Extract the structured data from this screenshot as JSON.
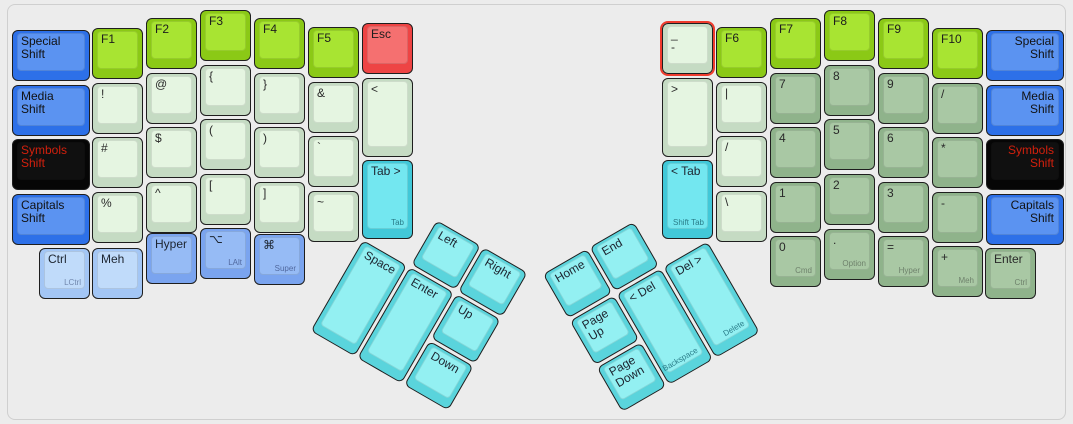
{
  "canvas": {
    "width": 1073,
    "height": 424,
    "background": "#ececec",
    "frame_border": "#cfcfcf",
    "selection_color": "#ef3b2d"
  },
  "palette": {
    "blue": {
      "base": "#2d70e8",
      "top": "#5b93f1",
      "text": "#111111",
      "sub": "#1f3a6e"
    },
    "black": {
      "base": "#060606",
      "top": "#101010",
      "text": "#d2200d",
      "sub": "#888888"
    },
    "green": {
      "base": "#8bc916",
      "top": "#a8e432",
      "text": "#1d1d1d",
      "sub": "#5d7d12"
    },
    "red": {
      "base": "#ee4444",
      "top": "#f57070",
      "text": "#1d1d1d",
      "sub": "#8a2525"
    },
    "mint": {
      "base": "#c5dbc3",
      "top": "#e5f5e1",
      "text": "#2a2a2a",
      "sub": "#7f917e"
    },
    "sage": {
      "base": "#8fb38b",
      "top": "#a9c8a4",
      "text": "#2a2a2a",
      "sub": "#6f826c"
    },
    "cyan": {
      "base": "#41c8d8",
      "top": "#73e7f0",
      "text": "#1d2530",
      "sub": "#2a7d89"
    },
    "cyanlight": {
      "base": "#5ad4dc",
      "top": "#93f0f2",
      "text": "#1d2530",
      "sub": "#2a7d89"
    },
    "bluelight": {
      "base": "#a3c6f5",
      "top": "#c0dbfa",
      "text": "#1d2530",
      "sub": "#7187ad"
    },
    "bluemed": {
      "base": "#7aa4ef",
      "top": "#96bbf5",
      "text": "#1d2530",
      "sub": "#51699f"
    }
  },
  "groups": {
    "left_thumb": {
      "x": 363,
      "y": 239.5,
      "rotation": 30
    },
    "right_thumb": {
      "x": 710,
      "y": 239.5,
      "rotation": -30
    }
  },
  "keys": [
    {
      "id": "special-shift-left",
      "label": "Special\nShift",
      "color": "blue",
      "x": 12,
      "y": 30,
      "w": 78
    },
    {
      "id": "media-shift-left",
      "label": "Media\nShift",
      "color": "blue",
      "x": 12,
      "y": 84.5,
      "w": 78
    },
    {
      "id": "symbols-shift-left",
      "label": "Symbols\nShift",
      "color": "black",
      "x": 12,
      "y": 139,
      "w": 78
    },
    {
      "id": "capitals-shift-left",
      "label": "Capitals\nShift",
      "color": "blue",
      "x": 12,
      "y": 193.5,
      "w": 78
    },
    {
      "id": "f1",
      "label": "F1",
      "color": "green",
      "x": 92,
      "y": 28
    },
    {
      "id": "exclamation",
      "label": "!",
      "color": "mint",
      "x": 92,
      "y": 82.5
    },
    {
      "id": "hash",
      "label": "#",
      "color": "mint",
      "x": 92,
      "y": 137
    },
    {
      "id": "percent",
      "label": "%",
      "color": "mint",
      "x": 92,
      "y": 191.5
    },
    {
      "id": "f2",
      "label": "F2",
      "color": "green",
      "x": 146,
      "y": 18
    },
    {
      "id": "at",
      "label": "@",
      "color": "mint",
      "x": 146,
      "y": 72.5
    },
    {
      "id": "dollar",
      "label": "$",
      "color": "mint",
      "x": 146,
      "y": 127
    },
    {
      "id": "caret",
      "label": "^",
      "color": "mint",
      "x": 146,
      "y": 181.5
    },
    {
      "id": "f3",
      "label": "F3",
      "color": "green",
      "x": 200,
      "y": 10
    },
    {
      "id": "open-brace",
      "label": "{",
      "color": "mint",
      "x": 200,
      "y": 64.5
    },
    {
      "id": "open-paren",
      "label": "(",
      "color": "mint",
      "x": 200,
      "y": 119
    },
    {
      "id": "open-bracket",
      "label": "[",
      "color": "mint",
      "x": 200,
      "y": 173.5
    },
    {
      "id": "f4",
      "label": "F4",
      "color": "green",
      "x": 254,
      "y": 18
    },
    {
      "id": "close-brace",
      "label": "}",
      "color": "mint",
      "x": 254,
      "y": 72.5
    },
    {
      "id": "close-paren",
      "label": ")",
      "color": "mint",
      "x": 254,
      "y": 127
    },
    {
      "id": "close-bracket",
      "label": "]",
      "color": "mint",
      "x": 254,
      "y": 181.5
    },
    {
      "id": "f5",
      "label": "F5",
      "color": "green",
      "x": 308,
      "y": 27
    },
    {
      "id": "ampersand",
      "label": "&",
      "color": "mint",
      "x": 308,
      "y": 81.5
    },
    {
      "id": "backtick",
      "label": "`",
      "color": "mint",
      "x": 308,
      "y": 136
    },
    {
      "id": "tilde",
      "label": "~",
      "color": "mint",
      "x": 308,
      "y": 190.5
    },
    {
      "id": "esc",
      "label": "Esc",
      "color": "red",
      "x": 362,
      "y": 23
    },
    {
      "id": "less-than",
      "label": "<",
      "color": "mint",
      "x": 362,
      "y": 77.5,
      "h": 79
    },
    {
      "id": "tab",
      "label": "Tab >",
      "sub": "Tab",
      "color": "cyan",
      "x": 362,
      "y": 159.5,
      "h": 79
    },
    {
      "id": "lctrl",
      "label": "Ctrl",
      "sub": "LCtrl",
      "color": "bluelight",
      "x": 39,
      "y": 248
    },
    {
      "id": "meh",
      "label": "Meh",
      "color": "bluelight",
      "x": 92,
      "y": 248
    },
    {
      "id": "hyper-left",
      "label": "Hyper",
      "color": "bluemed",
      "x": 146,
      "y": 233
    },
    {
      "id": "lalt",
      "label": "⌥",
      "sub": "LAlt",
      "color": "bluemed",
      "x": 200,
      "y": 228
    },
    {
      "id": "super",
      "label": "⌘",
      "sub": "Super",
      "color": "bluemed",
      "x": 254,
      "y": 234
    },
    {
      "id": "underscore-hyphen",
      "label": "_\n-",
      "color": "mint",
      "x": 662,
      "y": 23,
      "selected": true
    },
    {
      "id": "greater-than",
      "label": ">",
      "color": "mint",
      "x": 662,
      "y": 77.5,
      "h": 79
    },
    {
      "id": "shift-tab",
      "label": "< Tab",
      "sub": "Shift Tab",
      "subAlign": "left",
      "color": "cyan",
      "x": 662,
      "y": 159.5,
      "h": 79
    },
    {
      "id": "f6",
      "label": "F6",
      "color": "green",
      "x": 716,
      "y": 27
    },
    {
      "id": "pipe",
      "label": "|",
      "color": "mint",
      "x": 716,
      "y": 81.5
    },
    {
      "id": "slash",
      "label": "/",
      "color": "mint",
      "x": 716,
      "y": 136
    },
    {
      "id": "backslash",
      "label": "\\",
      "color": "mint",
      "x": 716,
      "y": 190.5
    },
    {
      "id": "f7",
      "label": "F7",
      "color": "green",
      "x": 770,
      "y": 18
    },
    {
      "id": "num-7",
      "label": "7",
      "color": "sage",
      "x": 770,
      "y": 72.5
    },
    {
      "id": "num-4",
      "label": "4",
      "color": "sage",
      "x": 770,
      "y": 127
    },
    {
      "id": "num-1",
      "label": "1",
      "color": "sage",
      "x": 770,
      "y": 181.5
    },
    {
      "id": "num-0",
      "label": "0",
      "sub": "Cmd",
      "color": "sage",
      "x": 770,
      "y": 236
    },
    {
      "id": "f8",
      "label": "F8",
      "color": "green",
      "x": 824,
      "y": 10
    },
    {
      "id": "num-8",
      "label": "8",
      "color": "sage",
      "x": 824,
      "y": 64.5
    },
    {
      "id": "num-5",
      "label": "5",
      "color": "sage",
      "x": 824,
      "y": 119
    },
    {
      "id": "num-2",
      "label": "2",
      "color": "sage",
      "x": 824,
      "y": 173.5
    },
    {
      "id": "num-dot",
      "label": ".",
      "sub": "Option",
      "color": "sage",
      "x": 824,
      "y": 229
    },
    {
      "id": "f9",
      "label": "F9",
      "color": "green",
      "x": 878,
      "y": 18
    },
    {
      "id": "num-9",
      "label": "9",
      "color": "sage",
      "x": 878,
      "y": 72.5
    },
    {
      "id": "num-6",
      "label": "6",
      "color": "sage",
      "x": 878,
      "y": 127
    },
    {
      "id": "num-3",
      "label": "3",
      "color": "sage",
      "x": 878,
      "y": 181.5
    },
    {
      "id": "num-equals",
      "label": "=",
      "sub": "Hyper",
      "color": "sage",
      "x": 878,
      "y": 236
    },
    {
      "id": "f10",
      "label": "F10",
      "color": "green",
      "x": 932,
      "y": 28
    },
    {
      "id": "num-slash",
      "label": "/",
      "color": "sage",
      "x": 932,
      "y": 82.5
    },
    {
      "id": "num-asterisk",
      "label": "*",
      "color": "sage",
      "x": 932,
      "y": 137
    },
    {
      "id": "num-minus",
      "label": "-",
      "color": "sage",
      "x": 932,
      "y": 191.5
    },
    {
      "id": "num-plus",
      "label": "+",
      "sub": "Meh",
      "color": "sage",
      "x": 932,
      "y": 246
    },
    {
      "id": "special-shift-right",
      "label": "Special\nShift",
      "color": "blue",
      "x": 986,
      "y": 30,
      "w": 78,
      "align": "right"
    },
    {
      "id": "media-shift-right",
      "label": "Media\nShift",
      "color": "blue",
      "x": 986,
      "y": 84.5,
      "w": 78,
      "align": "right"
    },
    {
      "id": "symbols-shift-right",
      "label": "Symbols\nShift",
      "color": "black",
      "x": 986,
      "y": 139,
      "w": 78,
      "align": "right"
    },
    {
      "id": "capitals-shift-right",
      "label": "Capitals\nShift",
      "color": "blue",
      "x": 986,
      "y": 193.5,
      "w": 78,
      "align": "right"
    },
    {
      "id": "enter-right",
      "label": "Enter",
      "sub": "Ctrl",
      "color": "sage",
      "x": 985,
      "y": 248
    },
    {
      "id": "left-arrow",
      "label": "Left",
      "color": "cyanlight",
      "x": 54,
      "y": -54,
      "group": "left_thumb"
    },
    {
      "id": "right-arrow",
      "label": "Right",
      "color": "cyanlight",
      "x": 108,
      "y": -54,
      "group": "left_thumb"
    },
    {
      "id": "space",
      "label": "Space",
      "color": "cyanlight",
      "x": 0,
      "y": 0,
      "h": 105,
      "group": "left_thumb"
    },
    {
      "id": "enter-thumb",
      "label": "Enter",
      "color": "cyanlight",
      "x": 54,
      "y": 0,
      "h": 105,
      "group": "left_thumb"
    },
    {
      "id": "up-arrow",
      "label": "Up",
      "color": "cyanlight",
      "x": 108,
      "y": 0,
      "group": "left_thumb"
    },
    {
      "id": "down-arrow",
      "label": "Down",
      "color": "cyanlight",
      "x": 108,
      "y": 54,
      "group": "left_thumb"
    },
    {
      "id": "home",
      "label": "Home",
      "color": "cyanlight",
      "x": -162,
      "y": -54,
      "group": "right_thumb"
    },
    {
      "id": "end",
      "label": "End",
      "color": "cyanlight",
      "x": -108,
      "y": -54,
      "group": "right_thumb"
    },
    {
      "id": "page-up",
      "label": "Page\nUp",
      "color": "cyanlight",
      "x": -162,
      "y": 0,
      "group": "right_thumb"
    },
    {
      "id": "page-down",
      "label": "Page\nDown",
      "color": "cyanlight",
      "x": -162,
      "y": 54,
      "group": "right_thumb"
    },
    {
      "id": "backspace",
      "label": "< Del",
      "sub": "Backspace",
      "color": "cyanlight",
      "x": -108,
      "y": 0,
      "h": 105,
      "group": "right_thumb"
    },
    {
      "id": "delete",
      "label": "Del >",
      "sub": "Delete",
      "color": "cyanlight",
      "x": -54,
      "y": 0,
      "h": 105,
      "group": "right_thumb"
    }
  ]
}
